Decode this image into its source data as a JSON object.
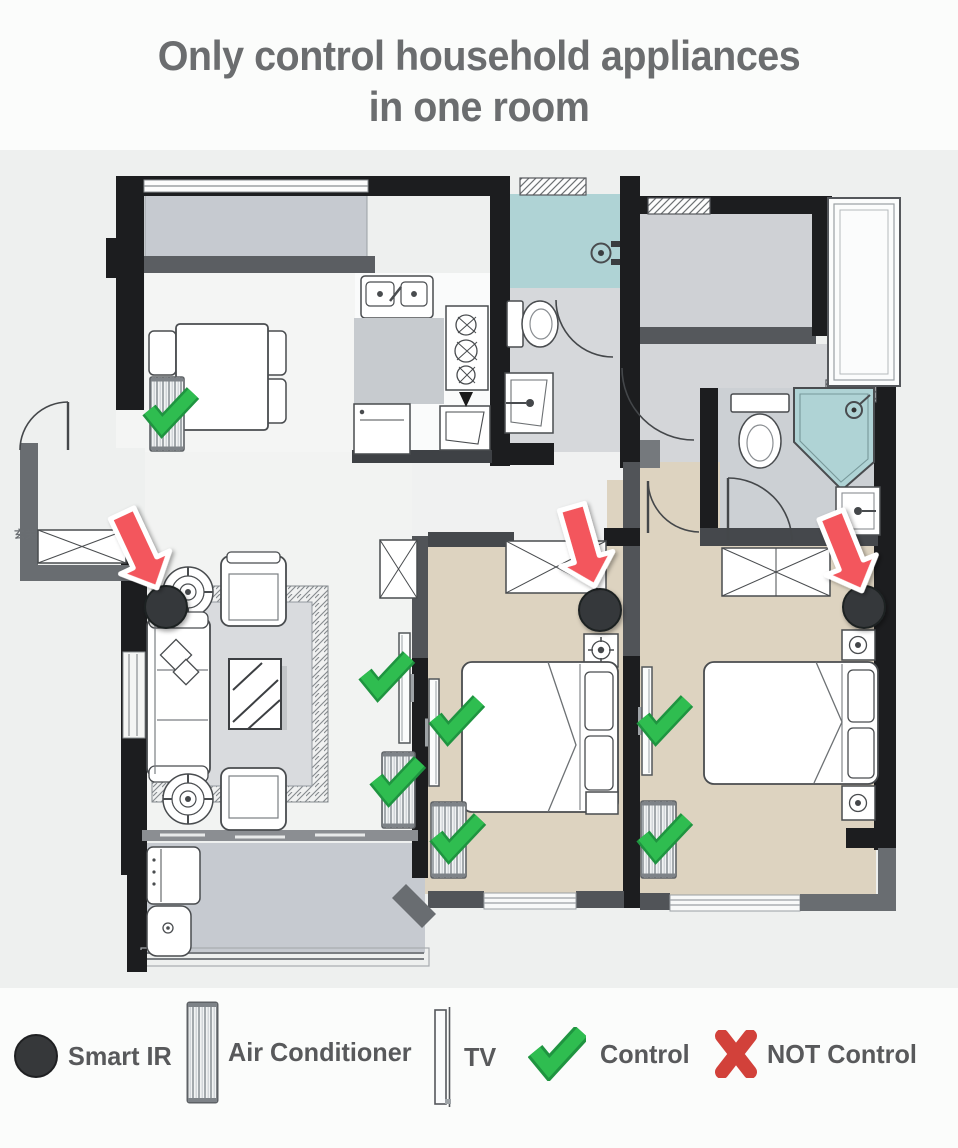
{
  "title": {
    "line1": "Only control household appliances",
    "line2": "in one room"
  },
  "colors": {
    "title_gray": "#6b6d6f",
    "legend_text_gray": "#58595b",
    "wall_black": "#1c1d1f",
    "wall_gray": "#55585c",
    "bedroom_tan": "#ddd3c0",
    "bathroom_teal": "#afd3d5",
    "balcony_gray": "#c6cad0",
    "arrow_red": "#f3575d",
    "check_green": "#2fbd50",
    "check_green_dark": "#1f9440",
    "cross_red": "#d2413a",
    "smart_ir_black": "#36383a"
  },
  "legend": {
    "items": [
      {
        "icon": "smart-ir-icon",
        "label": "Smart IR"
      },
      {
        "icon": "air-conditioner-icon",
        "label": "Air Conditioner"
      },
      {
        "icon": "tv-icon",
        "label": "TV"
      },
      {
        "icon": "check-icon",
        "label": "Control"
      },
      {
        "icon": "cross-icon",
        "label": "NOT Control"
      }
    ]
  },
  "floorplan": {
    "entry_label": "玄关",
    "smart_ir_devices": [
      {
        "room": "living-room",
        "x": 166,
        "y": 607
      },
      {
        "room": "bedroom-1",
        "x": 600,
        "y": 610
      },
      {
        "room": "bedroom-2",
        "x": 864,
        "y": 607
      }
    ],
    "arrows": [
      {
        "room": "living-room",
        "x": 156,
        "y": 586,
        "rotate": -25
      },
      {
        "room": "bedroom-1",
        "x": 594,
        "y": 584,
        "rotate": -16
      },
      {
        "room": "bedroom-2",
        "x": 861,
        "y": 589,
        "rotate": -22
      }
    ],
    "air_conditioners": [
      {
        "room": "dining-room",
        "x": 150,
        "y": 377,
        "w": 34,
        "h": 74,
        "controlled": true,
        "check": {
          "x": 170,
          "y": 413
        }
      },
      {
        "room": "living-room",
        "x": 382,
        "y": 752,
        "w": 33,
        "h": 76,
        "controlled": true,
        "check": {
          "x": 397,
          "y": 782
        }
      },
      {
        "room": "bedroom-1",
        "x": 431,
        "y": 802,
        "w": 35,
        "h": 76,
        "controlled": true,
        "check": {
          "x": 457,
          "y": 839
        }
      },
      {
        "room": "bedroom-2",
        "x": 641,
        "y": 801,
        "w": 35,
        "h": 77,
        "controlled": true,
        "check": {
          "x": 664,
          "y": 839
        }
      }
    ],
    "tvs": [
      {
        "room": "living-room",
        "x": 399,
        "y": 633,
        "w": 11,
        "h": 110,
        "bracket": "right",
        "controlled": true,
        "check": {
          "x": 386,
          "y": 677
        }
      },
      {
        "room": "bedroom-1",
        "x": 429,
        "y": 679,
        "w": 10,
        "h": 107,
        "bracket": "left",
        "controlled": true,
        "check": {
          "x": 456,
          "y": 721
        }
      },
      {
        "room": "bedroom-2",
        "x": 642,
        "y": 667,
        "w": 10,
        "h": 108,
        "bracket": "left",
        "controlled": true,
        "check": {
          "x": 664,
          "y": 721
        }
      }
    ]
  }
}
